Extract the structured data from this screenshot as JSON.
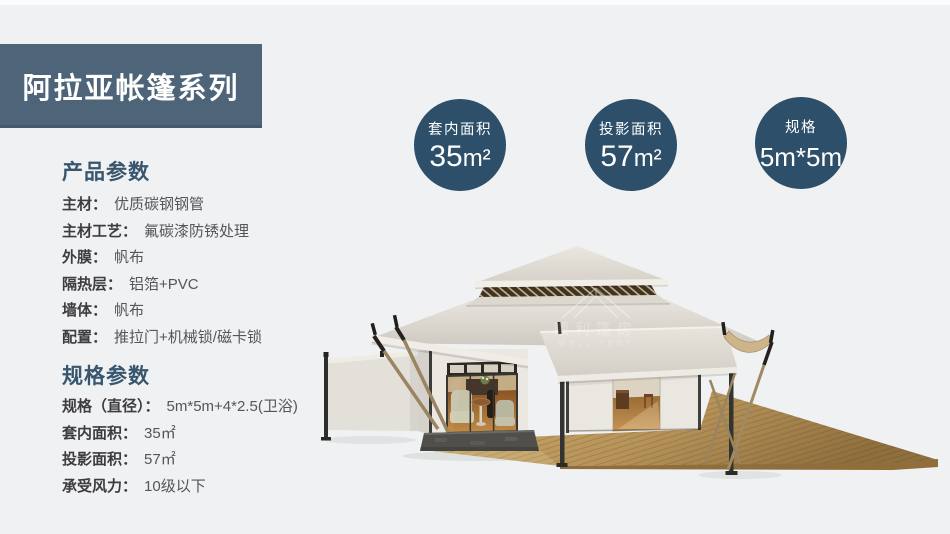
{
  "banner": {
    "title": "阿拉亚帐篷系列",
    "bg": "#4e6579"
  },
  "product_params": {
    "heading": "产品参数",
    "items": [
      {
        "label": "主材：",
        "value": "优质碳钢钢管"
      },
      {
        "label": "主材工艺：",
        "value": "氟碳漆防锈处理"
      },
      {
        "label": "外膜：",
        "value": "帆布"
      },
      {
        "label": "隔热层：",
        "value": "铝箔+PVC"
      },
      {
        "label": "墙体：",
        "value": "帆布"
      },
      {
        "label": "配置：",
        "value": "推拉门+机械锁/磁卡锁"
      }
    ]
  },
  "spec_params": {
    "heading": "规格参数",
    "items": [
      {
        "label": "规格（直径）：",
        "value": "5m*5m+4*2.5(卫浴)"
      },
      {
        "label": "套内面积：",
        "value": "35㎡"
      },
      {
        "label": "投影面积：",
        "value": "57㎡"
      },
      {
        "label": "承受风力：",
        "value": "10级以下"
      }
    ]
  },
  "badges": [
    {
      "label": "套内面积",
      "num": "35",
      "unit": "m²"
    },
    {
      "label": "投影面积",
      "num": "57",
      "unit": "m²"
    },
    {
      "label": "规格",
      "num": "5m*5m",
      "unit": ""
    }
  ],
  "badge_color": "#2d4f69",
  "watermark": {
    "text_cn": "顺利篷房",
    "text_en": "WELL TENT"
  }
}
